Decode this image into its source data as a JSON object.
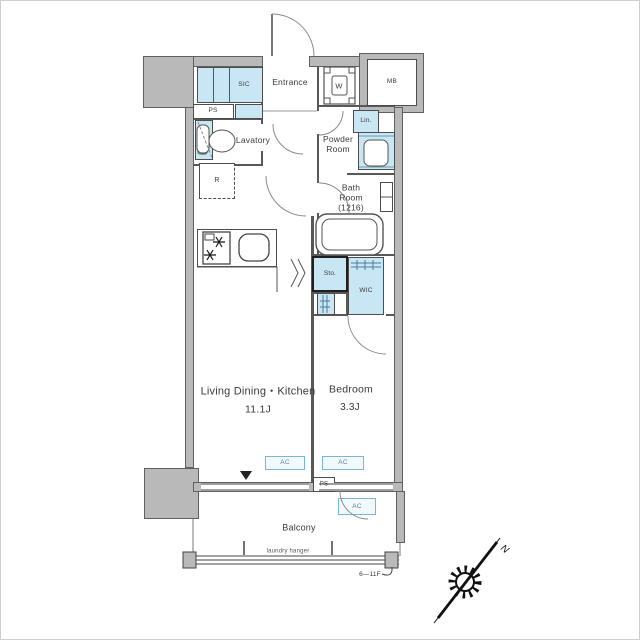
{
  "colors": {
    "wall_gray": "#b9b9b9",
    "fixture_blue": "#c9e6f4",
    "line_dark": "#4d4d4d",
    "ac_box_border": "#7ab5d6",
    "ac_text": "#56809c"
  },
  "plan": {
    "labels": {
      "entrance": "Entrance",
      "sic": "SIC",
      "ps_top": "PS",
      "washer": "W",
      "meter_box": "MB",
      "linen": "Lin.",
      "lavatory": "Lavatory",
      "powder_room": "Powder\nRoom",
      "bath_room": "Bath\nRoom\n(1216)",
      "refrigerator": "R",
      "storage": "Sto.",
      "wic": "WIC",
      "ldk": "Living Dining・Kitchen",
      "ldk_size": "11.1J",
      "bedroom": "Bedroom",
      "bedroom_size": "3.3J",
      "ac_living": "AC",
      "ac_bedroom": "AC",
      "ac_outdoor": "AC",
      "ps_bottom": "PS",
      "balcony": "Balcony",
      "laundry_hanger": "laundry hanger",
      "floor_range": "6—11F",
      "compass_north": "N"
    }
  }
}
